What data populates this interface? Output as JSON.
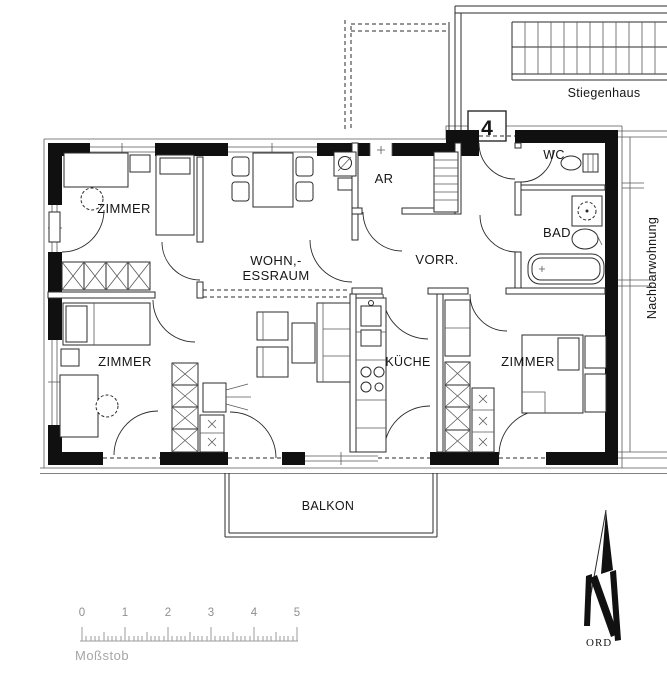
{
  "plan": {
    "unit_number": "4",
    "rooms": {
      "zimmer_top_left": "ZIMMER",
      "wohn_essraum_line1": "WOHN,-",
      "wohn_essraum_line2": "ESSRAUM",
      "ar": "AR",
      "vorr": "VORR.",
      "wc": "WC",
      "bad": "BAD",
      "kueche": "KÜCHE",
      "zimmer_bottom_left": "ZIMMER",
      "zimmer_bottom_right": "ZIMMER",
      "balkon": "BALKON"
    },
    "annotations": {
      "stairwell": "Stiegenhaus",
      "neighbor_apartment": "Nachbarwohnung",
      "north_suffix": "ORD",
      "scale_label": "Moßstob",
      "scale_ticks": [
        "0",
        "1",
        "2",
        "3",
        "4",
        "5"
      ]
    },
    "colors": {
      "line": "#2b2b2b",
      "wall": "#101010",
      "muted": "#9b9b9b"
    }
  }
}
